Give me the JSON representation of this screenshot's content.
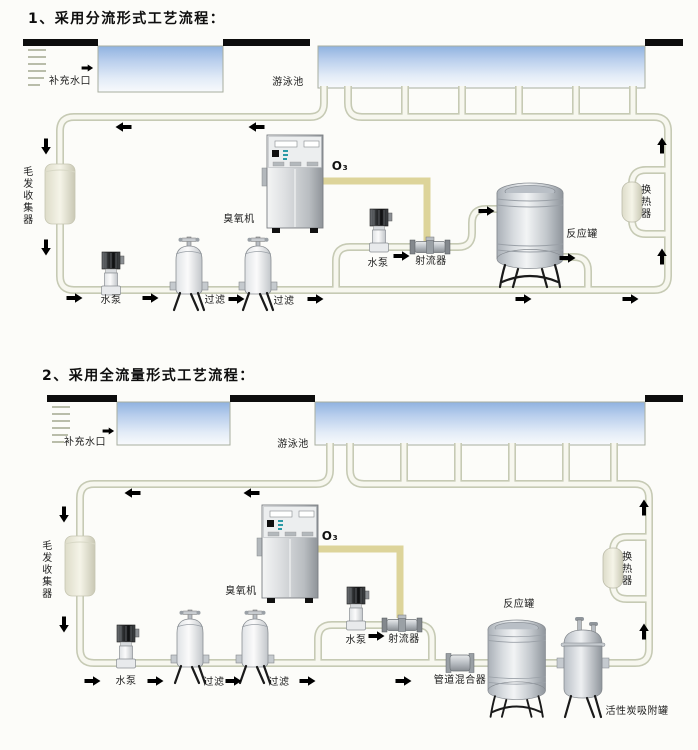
{
  "diagram1": {
    "title": "1、采用分流形式工艺流程：",
    "pool": {
      "makeup_inlet": "补充水口",
      "name": "游泳池"
    },
    "equipment": {
      "hair_collector": "毛发收集器",
      "main_pump": "水泵",
      "filter_1": "过滤",
      "filter_2": "过滤",
      "ozone_generator": "臭氧机",
      "ozone_gas": "O₃",
      "booster_pump": "水泵",
      "injector": "射流器",
      "reaction_tank": "反应罐",
      "heat_exchanger": "换热器"
    }
  },
  "diagram2": {
    "title": "2、采用全流量形式工艺流程：",
    "pool": {
      "makeup_inlet": "补充水口",
      "name": "游泳池"
    },
    "equipment": {
      "hair_collector": "毛发收集器",
      "main_pump": "水泵",
      "filter_1": "过滤",
      "filter_2": "过滤",
      "ozone_generator": "臭氧机",
      "ozone_gas": "O₃",
      "booster_pump": "水泵",
      "injector": "射流器",
      "pipeline_mixer": "管道混合器",
      "reaction_tank": "反应罐",
      "carbon_tank": "活性炭吸附罐",
      "heat_exchanger": "换热器"
    }
  },
  "colors": {
    "water_top": "#8fb2e0",
    "pipe_edge": "#c6cab4",
    "ozone_line": "#ddd49a",
    "arrow": "#1c2430",
    "pool_deck_bar": "#0d0d0d"
  }
}
